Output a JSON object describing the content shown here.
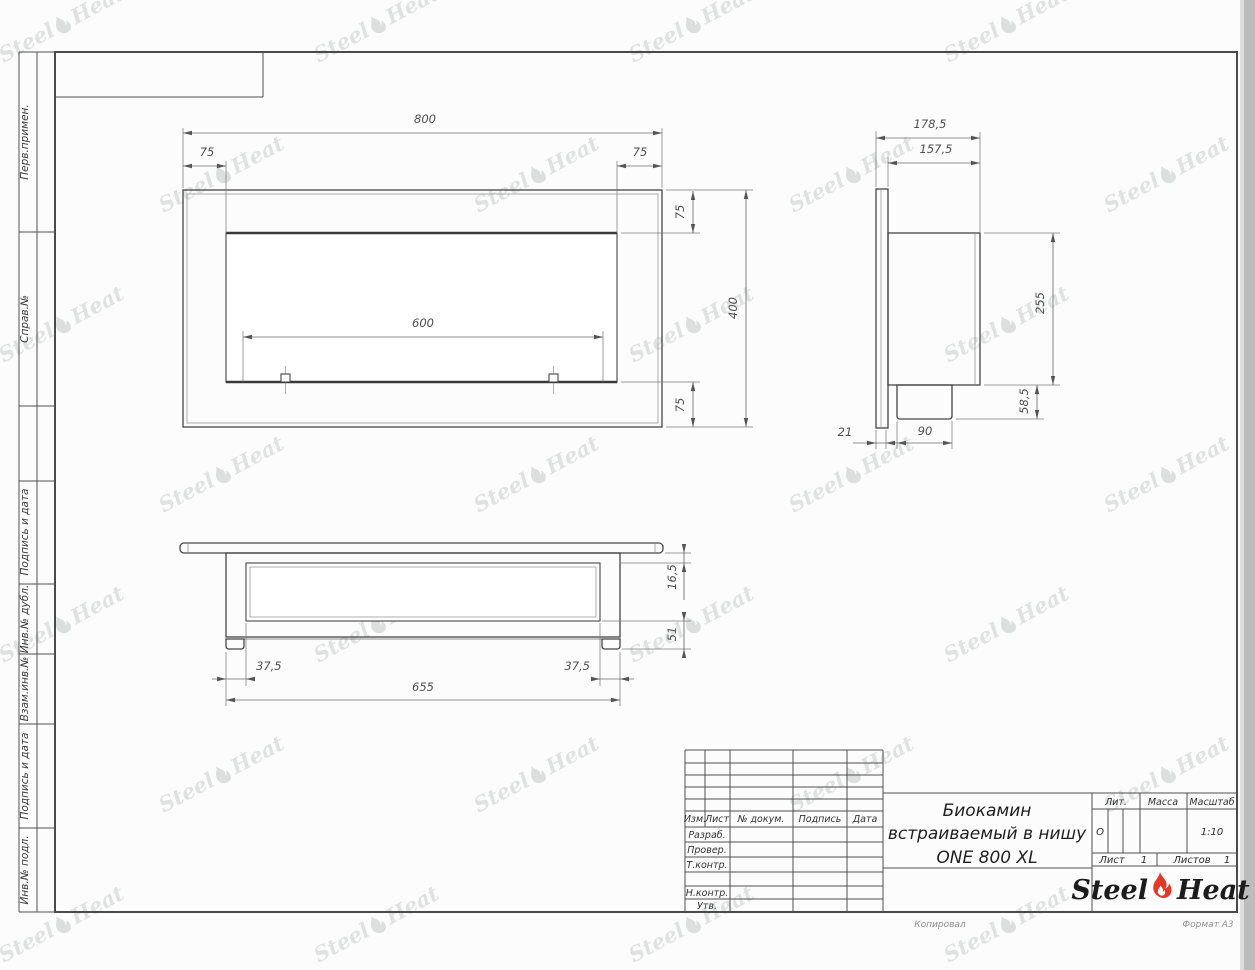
{
  "drawing": {
    "type": "engineering-drawing",
    "product": "Биокамин встраиваемый в нишу ONE 800 XL"
  },
  "margin_labels": [
    "Перв.примен.",
    "Справ.№",
    "Подпись и дата",
    "Инв.№ дубл.",
    "Взам.инв.№",
    "Подпись и дата",
    "Инв.№ подл."
  ],
  "views": {
    "front": {
      "width": "800",
      "offset_left": "75",
      "offset_right": "75",
      "offset_top": "75",
      "offset_bottom": "75",
      "burner_width": "600",
      "height": "400"
    },
    "side": {
      "total_depth": "178,5",
      "body_depth": "157,5",
      "body_height": "255",
      "box_height": "58,5",
      "flange_thickness": "21",
      "box_depth": "90"
    },
    "bottom": {
      "plate_thickness": "16,5",
      "inner_depth": "51",
      "offset_left": "37,5",
      "offset_right": "37,5",
      "body_width": "655"
    }
  },
  "title_block": {
    "header_cols": [
      "Изм.",
      "Лист",
      "№ докум.",
      "Подпись",
      "Дата"
    ],
    "roles": [
      "Разраб.",
      "Провер.",
      "Т.контр.",
      "Н.контр.",
      "Утв."
    ],
    "lit_label": "Лит.",
    "lit_value": "О",
    "mass_label": "Масса",
    "scale_label": "Масштаб",
    "scale_value": "1:10",
    "sheet_label": "Лист",
    "sheet_value": "1",
    "sheets_label": "Листов",
    "sheets_value": "1",
    "title_line1": "Биокамин",
    "title_line2": "встраиваемый в нишу",
    "title_line3": "ONE 800 XL",
    "logo_word1": "Steel",
    "logo_word2": "Heat"
  },
  "footer": {
    "copied": "Копировал",
    "format": "Формат А3"
  },
  "watermark": {
    "word1": "Steel",
    "word2": "Heat"
  },
  "colors": {
    "flame_red": "#e63624",
    "line": "#454545",
    "watermark": "#7d8880"
  }
}
